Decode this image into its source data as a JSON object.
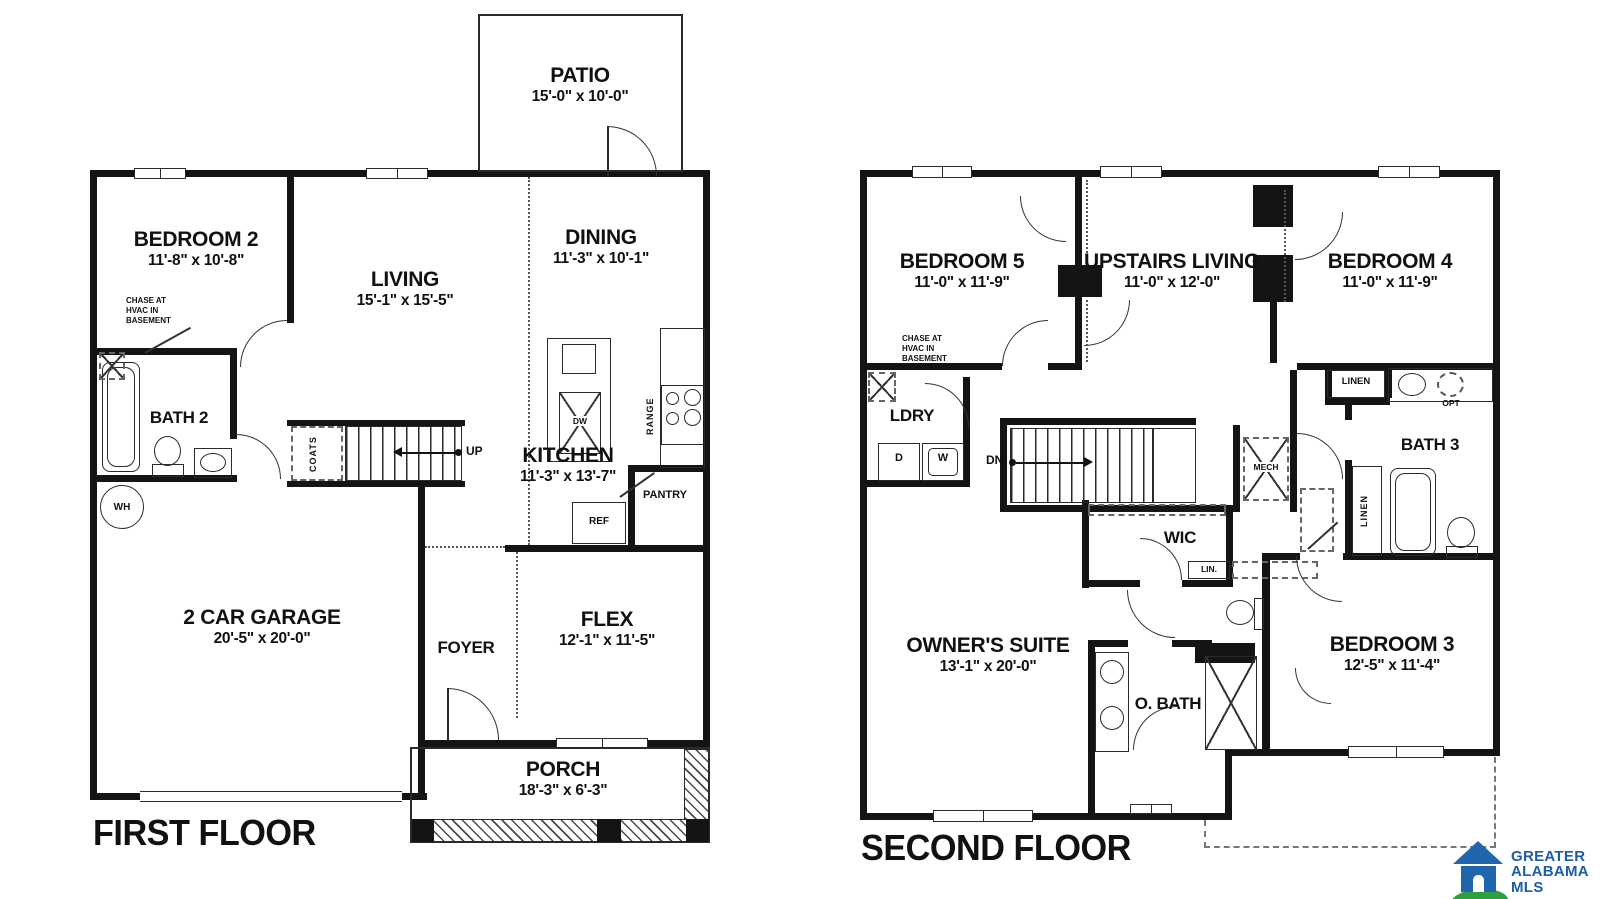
{
  "first_floor": {
    "title": "FIRST FLOOR",
    "patio": {
      "name": "PATIO",
      "dims": "15'-0\" x 10'-0\""
    },
    "bedroom2": {
      "name": "BEDROOM 2",
      "dims": "11'-8\" x 10'-8\""
    },
    "living": {
      "name": "LIVING",
      "dims": "15'-1\" x 15'-5\""
    },
    "dining": {
      "name": "DINING",
      "dims": "11'-3\" x 10'-1\""
    },
    "bath2": {
      "name": "BATH 2"
    },
    "kitchen": {
      "name": "KITCHEN",
      "dims": "11'-3\" x 13'-7\""
    },
    "garage": {
      "name": "2 CAR GARAGE",
      "dims": "20'-5\" x 20'-0\""
    },
    "foyer": {
      "name": "FOYER"
    },
    "flex": {
      "name": "FLEX",
      "dims": "12'-1\" x 11'-5\""
    },
    "porch": {
      "name": "PORCH",
      "dims": "18'-3\" x 6'-3\""
    },
    "notes": {
      "chase": "CHASE AT\nHVAC IN\nBASEMENT",
      "wh": "WH",
      "coats": "COATS",
      "up": "UP",
      "dw": "DW",
      "ref": "REF",
      "pantry": "PANTRY",
      "range": "RANGE"
    }
  },
  "second_floor": {
    "title": "SECOND FLOOR",
    "bedroom5": {
      "name": "BEDROOM 5",
      "dims": "11'-0\" x 11'-9\""
    },
    "upstairs_living": {
      "name": "UPSTAIRS LIVING",
      "dims": "11'-0\" x 12'-0\""
    },
    "bedroom4": {
      "name": "BEDROOM 4",
      "dims": "11'-0\" x 11'-9\""
    },
    "ldry": {
      "name": "LDRY"
    },
    "bath3": {
      "name": "BATH 3"
    },
    "wic": {
      "name": "WIC"
    },
    "owners_suite": {
      "name": "OWNER'S SUITE",
      "dims": "13'-1\" x 20'-0\""
    },
    "obath": {
      "name": "O. BATH"
    },
    "bedroom3": {
      "name": "BEDROOM 3",
      "dims": "12'-5\" x 11'-4\""
    },
    "notes": {
      "chase": "CHASE AT\nHVAC IN\nBASEMENT",
      "dn": "DN",
      "d": "D",
      "w": "W",
      "mech": "MECH",
      "linen": "LINEN",
      "lin": "LIN.",
      "opt": "OPT",
      "linen_vert": "LINEN"
    }
  },
  "logo": {
    "line1": "GREATER",
    "line2": "ALABAMA",
    "line3": "MLS"
  },
  "colors": {
    "line": "#141414",
    "logo_blue": "#1f66ad",
    "logo_green": "#2f9e41"
  }
}
